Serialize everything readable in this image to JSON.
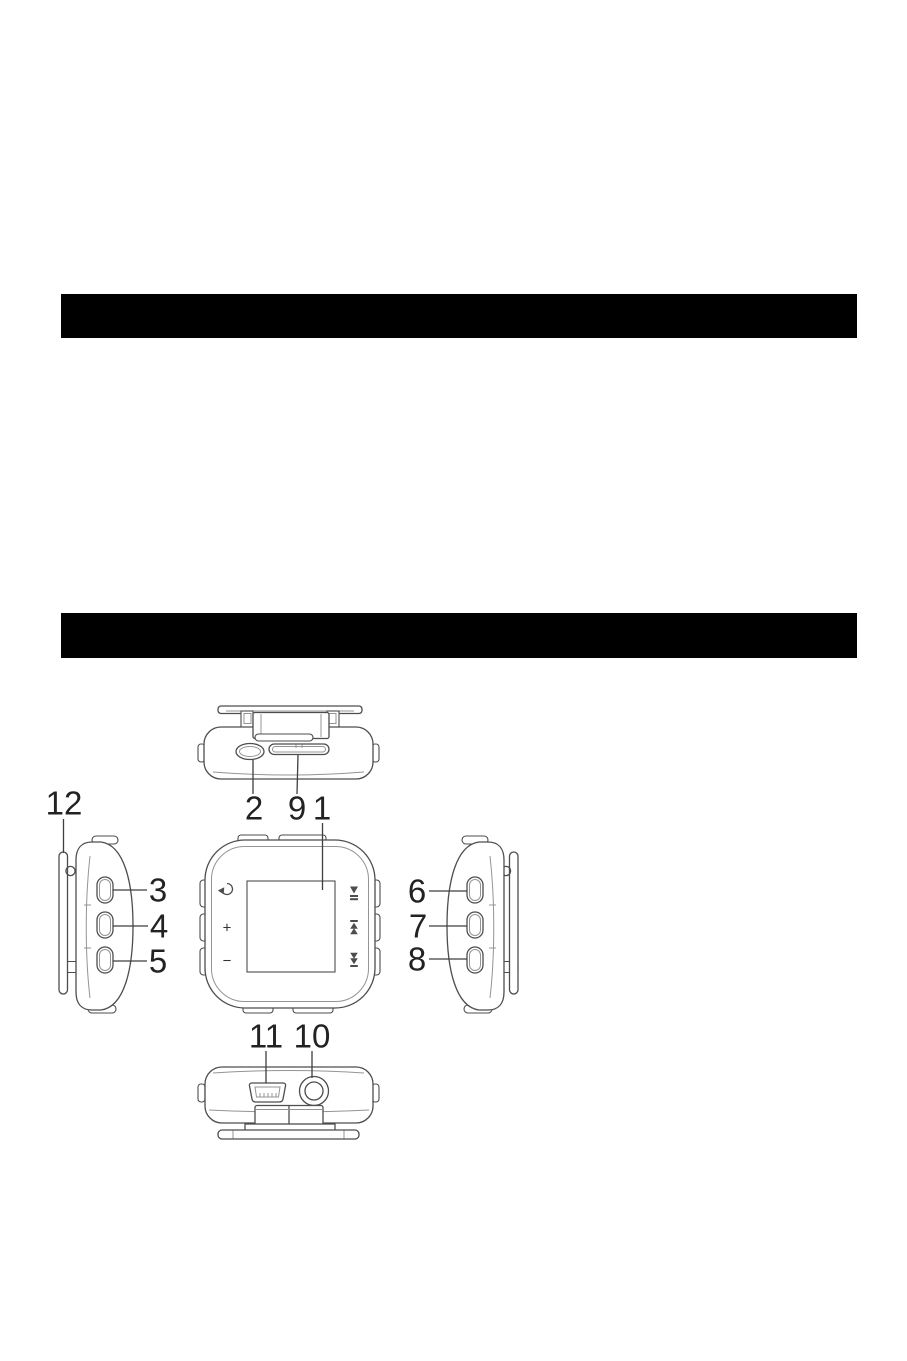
{
  "document": {
    "type": "device-manual-diagram-page",
    "background": "#ffffff",
    "section_bar_color": "#000000"
  },
  "diagram": {
    "callouts": {
      "c1": "1",
      "c2": "2",
      "c3": "3",
      "c4": "4",
      "c5": "5",
      "c6": "6",
      "c7": "7",
      "c8": "8",
      "c9": "9",
      "c10": "10",
      "c11": "11",
      "c12": "12"
    },
    "front_controls": {
      "volume_up": "+",
      "volume_down": "−"
    },
    "icons": {
      "back": "back-arrow-icon",
      "play_pause": "play-pause-icon",
      "previous": "previous-track-icon",
      "next": "next-track-icon",
      "usb": "micro-usb-port",
      "headphone": "headphone-jack",
      "clip": "belt-clip"
    }
  }
}
